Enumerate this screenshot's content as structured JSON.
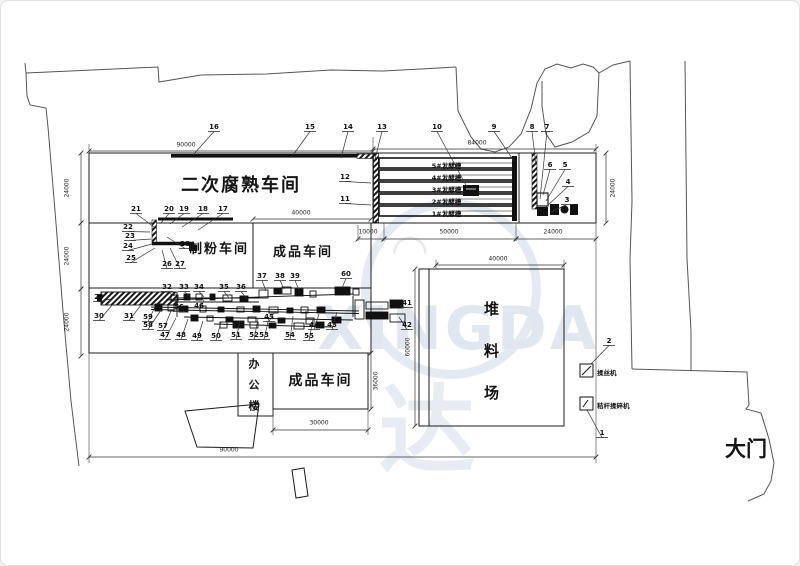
{
  "labels": {
    "fermentation_workshop": "二次腐熟车间",
    "milling_workshop": "制粉车间",
    "finished_workshop_main": "成品车间",
    "finished_workshop_south": "成品车间",
    "office_building": "办公楼",
    "stockyard": "堆料场",
    "main_gate": "大门"
  },
  "troughs": [
    "5#发酵槽",
    "4#发酵槽",
    "3#发酵槽",
    "2#发酵槽",
    "1#发酵槽"
  ],
  "legend": [
    {
      "no": "2",
      "label": "揉丝机"
    },
    {
      "no": "1",
      "label": "秸杆揉碎机"
    }
  ],
  "watermark": {
    "latin": "XINGDA",
    "cn": "达"
  },
  "colors": {
    "line": "#1c1c1c",
    "dim": "#333333",
    "watermark": "#e2e9f0"
  },
  "dimensions": [
    {
      "v": "90000",
      "o": "h",
      "x": 185,
      "y": 144,
      "x1": 88,
      "x2": 372,
      "ly": 150
    },
    {
      "v": "84000",
      "o": "h",
      "x": 476,
      "y": 142,
      "x1": 372,
      "x2": 595,
      "ly": 148
    },
    {
      "v": "40000",
      "o": "h",
      "x": 300,
      "y": 212,
      "x1": 252,
      "x2": 370,
      "ly": 218
    },
    {
      "v": "10000",
      "o": "h",
      "x": 367,
      "y": 231,
      "x1": 357,
      "x2": 383,
      "ly": 238
    },
    {
      "v": "50000",
      "o": "h",
      "x": 448,
      "y": 231,
      "x1": 383,
      "x2": 515,
      "ly": 238
    },
    {
      "v": "24000",
      "o": "h",
      "x": 552,
      "y": 231,
      "x1": 515,
      "x2": 595,
      "ly": 238
    },
    {
      "v": "40000",
      "o": "h",
      "x": 497,
      "y": 258,
      "x1": 435,
      "x2": 563,
      "ly": 264
    },
    {
      "v": "30000",
      "o": "h",
      "x": 318,
      "y": 422,
      "x1": 272,
      "x2": 367,
      "ly": 429
    },
    {
      "v": "90000",
      "o": "h",
      "x": 228,
      "y": 449,
      "x1": 88,
      "x2": 595,
      "ly": 456
    },
    {
      "v": "24000",
      "o": "v",
      "x": 66,
      "y": 187,
      "y1": 152,
      "y2": 222,
      "lx": 80
    },
    {
      "v": "24000",
      "o": "v",
      "x": 66,
      "y": 255,
      "y1": 222,
      "y2": 288,
      "lx": 80
    },
    {
      "v": "24000",
      "o": "v",
      "x": 66,
      "y": 321,
      "y1": 288,
      "y2": 355,
      "lx": 80
    },
    {
      "v": "24000",
      "o": "v",
      "x": 612,
      "y": 187,
      "y1": 152,
      "y2": 222,
      "lx": 605
    },
    {
      "v": "60000",
      "o": "v",
      "x": 407,
      "y": 346,
      "y1": 268,
      "y2": 425,
      "lx": 414
    },
    {
      "v": "36000",
      "o": "v",
      "x": 375,
      "y": 380,
      "y1": 352,
      "y2": 408,
      "lx": 370
    }
  ],
  "callouts": [
    {
      "n": "16",
      "x": 213,
      "y": 126,
      "tx": 192,
      "ty": 154
    },
    {
      "n": "15",
      "x": 309,
      "y": 126,
      "tx": 292,
      "ty": 154
    },
    {
      "n": "14",
      "x": 347,
      "y": 126,
      "tx": 340,
      "ty": 157
    },
    {
      "n": "13",
      "x": 381,
      "y": 126,
      "tx": 374,
      "ty": 158
    },
    {
      "n": "10",
      "x": 436,
      "y": 126,
      "tx": 466,
      "ty": 186
    },
    {
      "n": "9",
      "x": 493,
      "y": 126,
      "tx": 513,
      "ty": 160
    },
    {
      "n": "8",
      "x": 531,
      "y": 126,
      "tx": 535,
      "ty": 164
    },
    {
      "n": "7",
      "x": 546,
      "y": 126,
      "tx": 539,
      "ty": 198
    },
    {
      "n": "6",
      "x": 549,
      "y": 164,
      "tx": 542,
      "ty": 194
    },
    {
      "n": "5",
      "x": 564,
      "y": 164,
      "tx": 545,
      "ty": 200
    },
    {
      "n": "4",
      "x": 567,
      "y": 181,
      "tx": 545,
      "ty": 206
    },
    {
      "n": "3",
      "x": 566,
      "y": 199,
      "tx": 550,
      "ty": 211
    },
    {
      "n": "12",
      "x": 344,
      "y": 176,
      "tx": 370,
      "ty": 182
    },
    {
      "n": "11",
      "x": 344,
      "y": 198,
      "tx": 370,
      "ty": 204
    },
    {
      "n": "21",
      "x": 135,
      "y": 208,
      "tx": 153,
      "ty": 226
    },
    {
      "n": "20",
      "x": 168,
      "y": 208,
      "tx": 160,
      "ty": 222
    },
    {
      "n": "19",
      "x": 183,
      "y": 208,
      "tx": 169,
      "ty": 223
    },
    {
      "n": "18",
      "x": 202,
      "y": 208,
      "tx": 181,
      "ty": 226
    },
    {
      "n": "17",
      "x": 222,
      "y": 208,
      "tx": 197,
      "ty": 229
    },
    {
      "n": "22",
      "x": 127,
      "y": 226,
      "tx": 149,
      "ty": 231
    },
    {
      "n": "23",
      "x": 129,
      "y": 235,
      "tx": 150,
      "ty": 238
    },
    {
      "n": "24",
      "x": 127,
      "y": 245,
      "tx": 151,
      "ty": 243
    },
    {
      "n": "25",
      "x": 130,
      "y": 257,
      "tx": 154,
      "ty": 247
    },
    {
      "n": "26",
      "x": 166,
      "y": 263,
      "tx": 161,
      "ty": 249
    },
    {
      "n": "27",
      "x": 179,
      "y": 263,
      "tx": 169,
      "ty": 247
    },
    {
      "n": "28",
      "x": 184,
      "y": 243,
      "tx": 166,
      "ty": 236
    },
    {
      "n": "29",
      "x": 98,
      "y": 296,
      "tx": 110,
      "ty": 298
    },
    {
      "n": "30",
      "x": 98,
      "y": 315,
      "tx": 112,
      "ty": 303
    },
    {
      "n": "31",
      "x": 128,
      "y": 315,
      "tx": 140,
      "ty": 304
    },
    {
      "n": "59",
      "x": 147,
      "y": 316,
      "tx": 154,
      "ty": 306
    },
    {
      "n": "58",
      "x": 147,
      "y": 324,
      "tx": 160,
      "ty": 309
    },
    {
      "n": "57",
      "x": 162,
      "y": 325,
      "tx": 170,
      "ty": 310
    },
    {
      "n": "56",
      "x": 178,
      "y": 306,
      "tx": 176,
      "ty": 299
    },
    {
      "n": "46",
      "x": 198,
      "y": 305,
      "tx": 203,
      "ty": 299
    },
    {
      "n": "45",
      "x": 268,
      "y": 316,
      "tx": 274,
      "ty": 310
    },
    {
      "n": "47",
      "x": 164,
      "y": 334,
      "tx": 175,
      "ty": 317
    },
    {
      "n": "48",
      "x": 180,
      "y": 334,
      "tx": 187,
      "ty": 318
    },
    {
      "n": "49",
      "x": 196,
      "y": 335,
      "tx": 202,
      "ty": 320
    },
    {
      "n": "50",
      "x": 215,
      "y": 335,
      "tx": 220,
      "ty": 321
    },
    {
      "n": "51",
      "x": 235,
      "y": 334,
      "tx": 239,
      "ty": 320
    },
    {
      "n": "52",
      "x": 253,
      "y": 334,
      "tx": 257,
      "ty": 318
    },
    {
      "n": "53",
      "x": 263,
      "y": 334,
      "tx": 268,
      "ty": 316
    },
    {
      "n": "54",
      "x": 289,
      "y": 334,
      "tx": 292,
      "ty": 315
    },
    {
      "n": "55",
      "x": 308,
      "y": 335,
      "tx": 312,
      "ty": 318
    },
    {
      "n": "44",
      "x": 313,
      "y": 324,
      "tx": 318,
      "ty": 313
    },
    {
      "n": "43",
      "x": 331,
      "y": 324,
      "tx": 336,
      "ty": 311
    },
    {
      "n": "42",
      "x": 406,
      "y": 324,
      "tx": 398,
      "ty": 316
    },
    {
      "n": "41",
      "x": 406,
      "y": 302,
      "tx": 399,
      "ty": 306
    },
    {
      "n": "32",
      "x": 166,
      "y": 286,
      "tx": 173,
      "ty": 295
    },
    {
      "n": "33",
      "x": 183,
      "y": 286,
      "tx": 189,
      "ty": 295
    },
    {
      "n": "34",
      "x": 198,
      "y": 286,
      "tx": 203,
      "ty": 296
    },
    {
      "n": "35",
      "x": 223,
      "y": 286,
      "tx": 228,
      "ty": 297
    },
    {
      "n": "36",
      "x": 240,
      "y": 286,
      "tx": 246,
      "ty": 298
    },
    {
      "n": "37",
      "x": 261,
      "y": 275,
      "tx": 265,
      "ty": 290
    },
    {
      "n": "38",
      "x": 279,
      "y": 275,
      "tx": 283,
      "ty": 288
    },
    {
      "n": "39",
      "x": 294,
      "y": 275,
      "tx": 298,
      "ty": 289
    },
    {
      "n": "60",
      "x": 345,
      "y": 273,
      "tx": 341,
      "ty": 287
    },
    {
      "n": "2",
      "x": 608,
      "y": 340,
      "tx": 590,
      "ty": 363
    },
    {
      "n": "1",
      "x": 601,
      "y": 432,
      "tx": 586,
      "ty": 409
    }
  ]
}
